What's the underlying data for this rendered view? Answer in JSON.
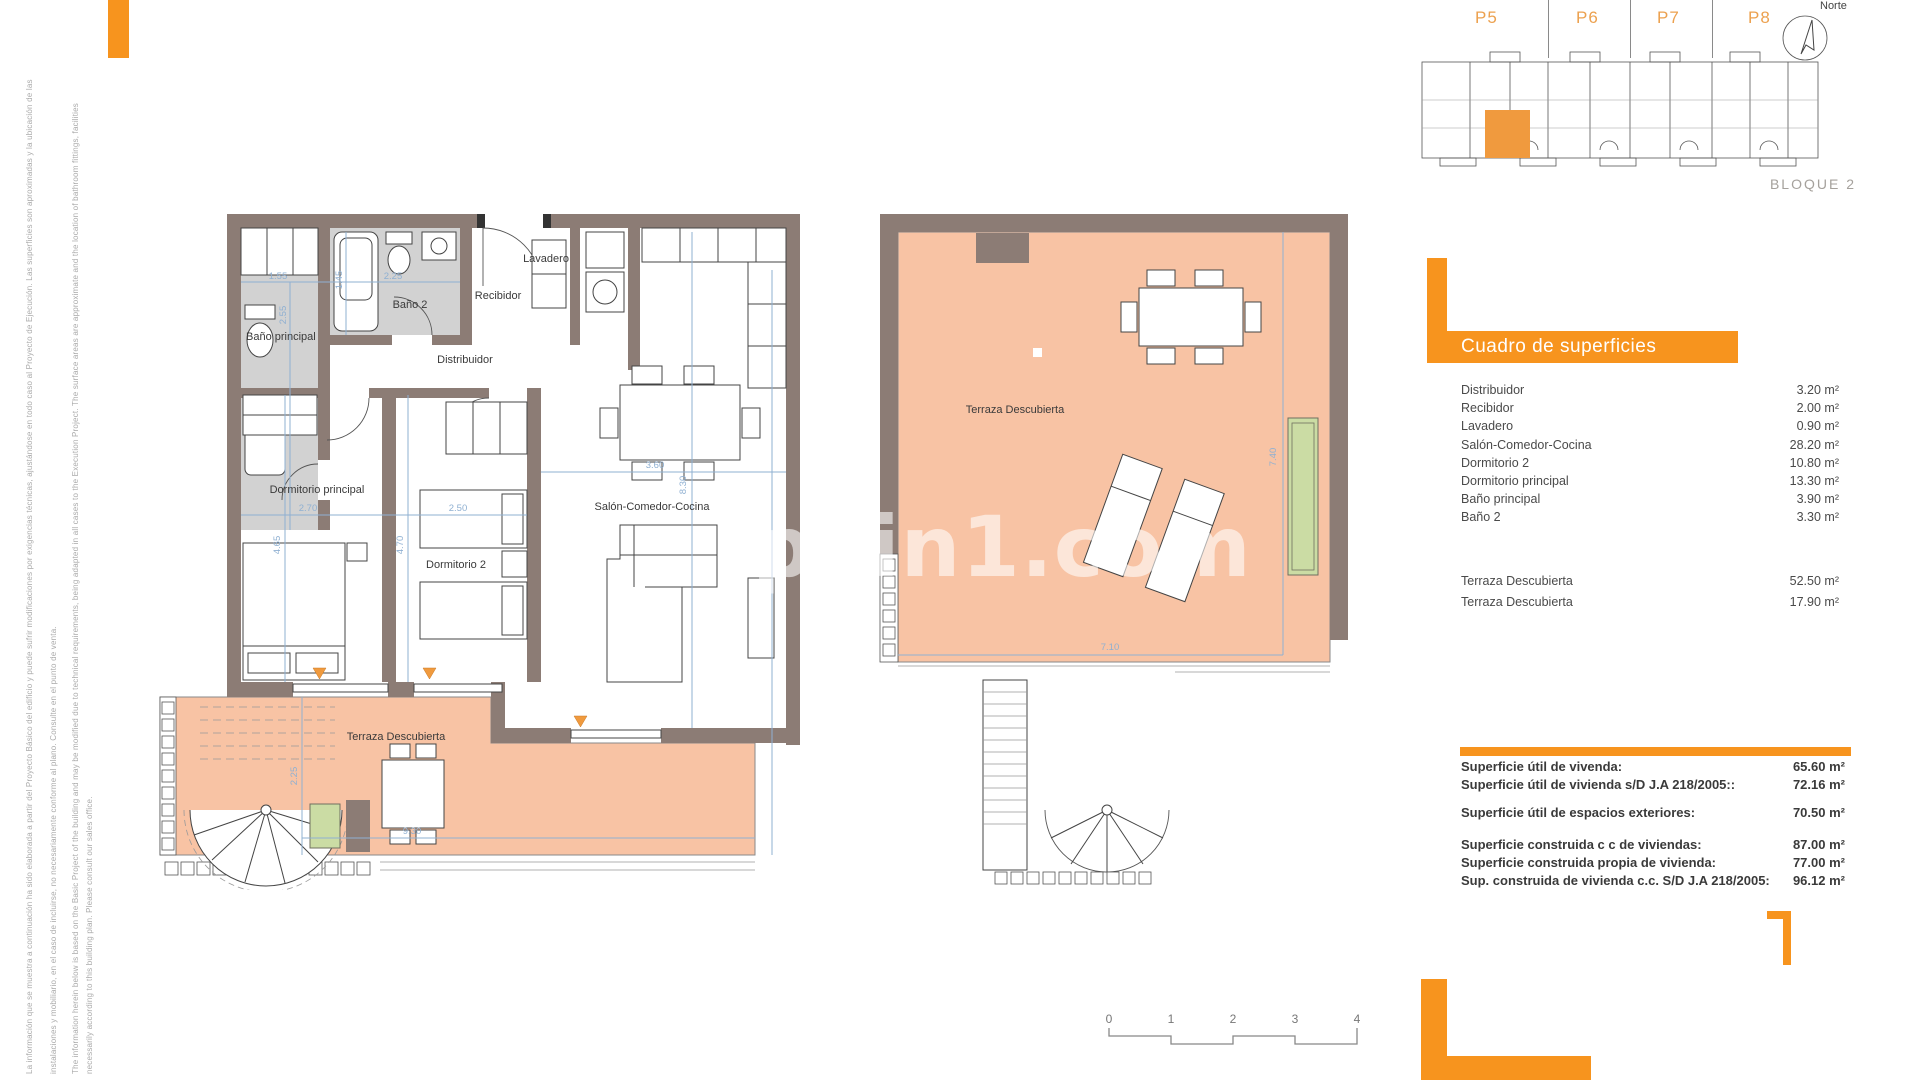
{
  "disclaimer": {
    "lines": [
      "La información que se muestra a continuación ha sido elaborada a partir del Proyecto Básico del edificio y puede sufrir modificaciones por exigencias técnicas, ajustándose en todo caso al Proyecto de Ejecución. Las superficies son aproximadas y la ubicación de las",
      "instalaciones y mobiliario, en el caso de incluirse, no necesariamente conforme al plano. Consulte en el punto de venta.",
      "The information herein below is based on the Basic Project of the building and may be modified due to technical requirements, being adapted in all cases to the Execution Project. The surface areas are approximate and the location of bathroom fittings, facilities",
      "necessarily according to this building plan. Please consult our sales office."
    ]
  },
  "key_plan": {
    "sections": [
      "P5",
      "P6",
      "P7",
      "P8"
    ],
    "north_label": "Norte",
    "block_label": "BLOQUE 2"
  },
  "watermark": "pain1.com",
  "left_plan": {
    "rooms": {
      "bano_principal": "Baño principal",
      "bano2": "Baño 2",
      "recibidor": "Recibidor",
      "lavadero": "Lavadero",
      "distribuidor": "Distribuidor",
      "dormitorio_principal": "Dormitorio principal",
      "dormitorio2": "Dormitorio 2",
      "salon": "Salón-Comedor-Cocina",
      "terraza": "Terraza Descubierta"
    },
    "dims": {
      "w155": "1.55",
      "w225": "2.25",
      "h145": "1.45",
      "h255": "2.55",
      "w270": "2.70",
      "h465": "4.65",
      "w250": "2.50",
      "h470": "4.70",
      "w360": "3.60",
      "h830": "8.30",
      "h225t": "2.25",
      "w930": "9.30"
    }
  },
  "middle_plan": {
    "room": "Terraza Descubierta",
    "dims": {
      "v740": "7.40",
      "h710": "7.10"
    }
  },
  "surfaces": {
    "title": "Cuadro de superficies",
    "rows": [
      {
        "label": "Distribuidor",
        "value": "3.20 m²"
      },
      {
        "label": "Recibidor",
        "value": "2.00 m²"
      },
      {
        "label": "Lavadero",
        "value": "0.90 m²"
      },
      {
        "label": "Salón-Comedor-Cocina",
        "value": "28.20 m²"
      },
      {
        "label": "Dormitorio 2",
        "value": "10.80 m²"
      },
      {
        "label": "Dormitorio principal",
        "value": "13.30 m²"
      },
      {
        "label": "Baño principal",
        "value": "3.90 m²"
      },
      {
        "label": "Baño 2",
        "value": "3.30 m²"
      }
    ],
    "terrace_rows": [
      {
        "label": "Terraza Descubierta",
        "value": "52.50 m²"
      },
      {
        "label": "Terraza Descubierta",
        "value": "17.90 m²"
      }
    ]
  },
  "summary": {
    "rows1": [
      {
        "label": "Superficie útil de vivenda:",
        "value": "65.60 m²"
      },
      {
        "label": "Superficie útil de vivienda s/D J.A 218/2005::",
        "value": "72.16 m²"
      }
    ],
    "rows2": [
      {
        "label": "Superficie útil de espacios exteriores:",
        "value": "70.50 m²"
      }
    ],
    "rows3": [
      {
        "label": "Superficie construida c c de viviendas:",
        "value": "87.00 m²"
      },
      {
        "label": "Superficie construida propia de vivienda:",
        "value": "77.00 m²"
      },
      {
        "label": "Sup. construida de vivienda c.c. S/D J.A 218/2005:",
        "value": "96.12 m²"
      }
    ]
  },
  "scale_bar": {
    "ticks": [
      "0",
      "1",
      "2",
      "3",
      "4"
    ]
  },
  "colors": {
    "accent": "#F7941E",
    "terrace": "#F8C3A4",
    "wall": "#8C7C75",
    "dimension": "#8FB0D2"
  }
}
